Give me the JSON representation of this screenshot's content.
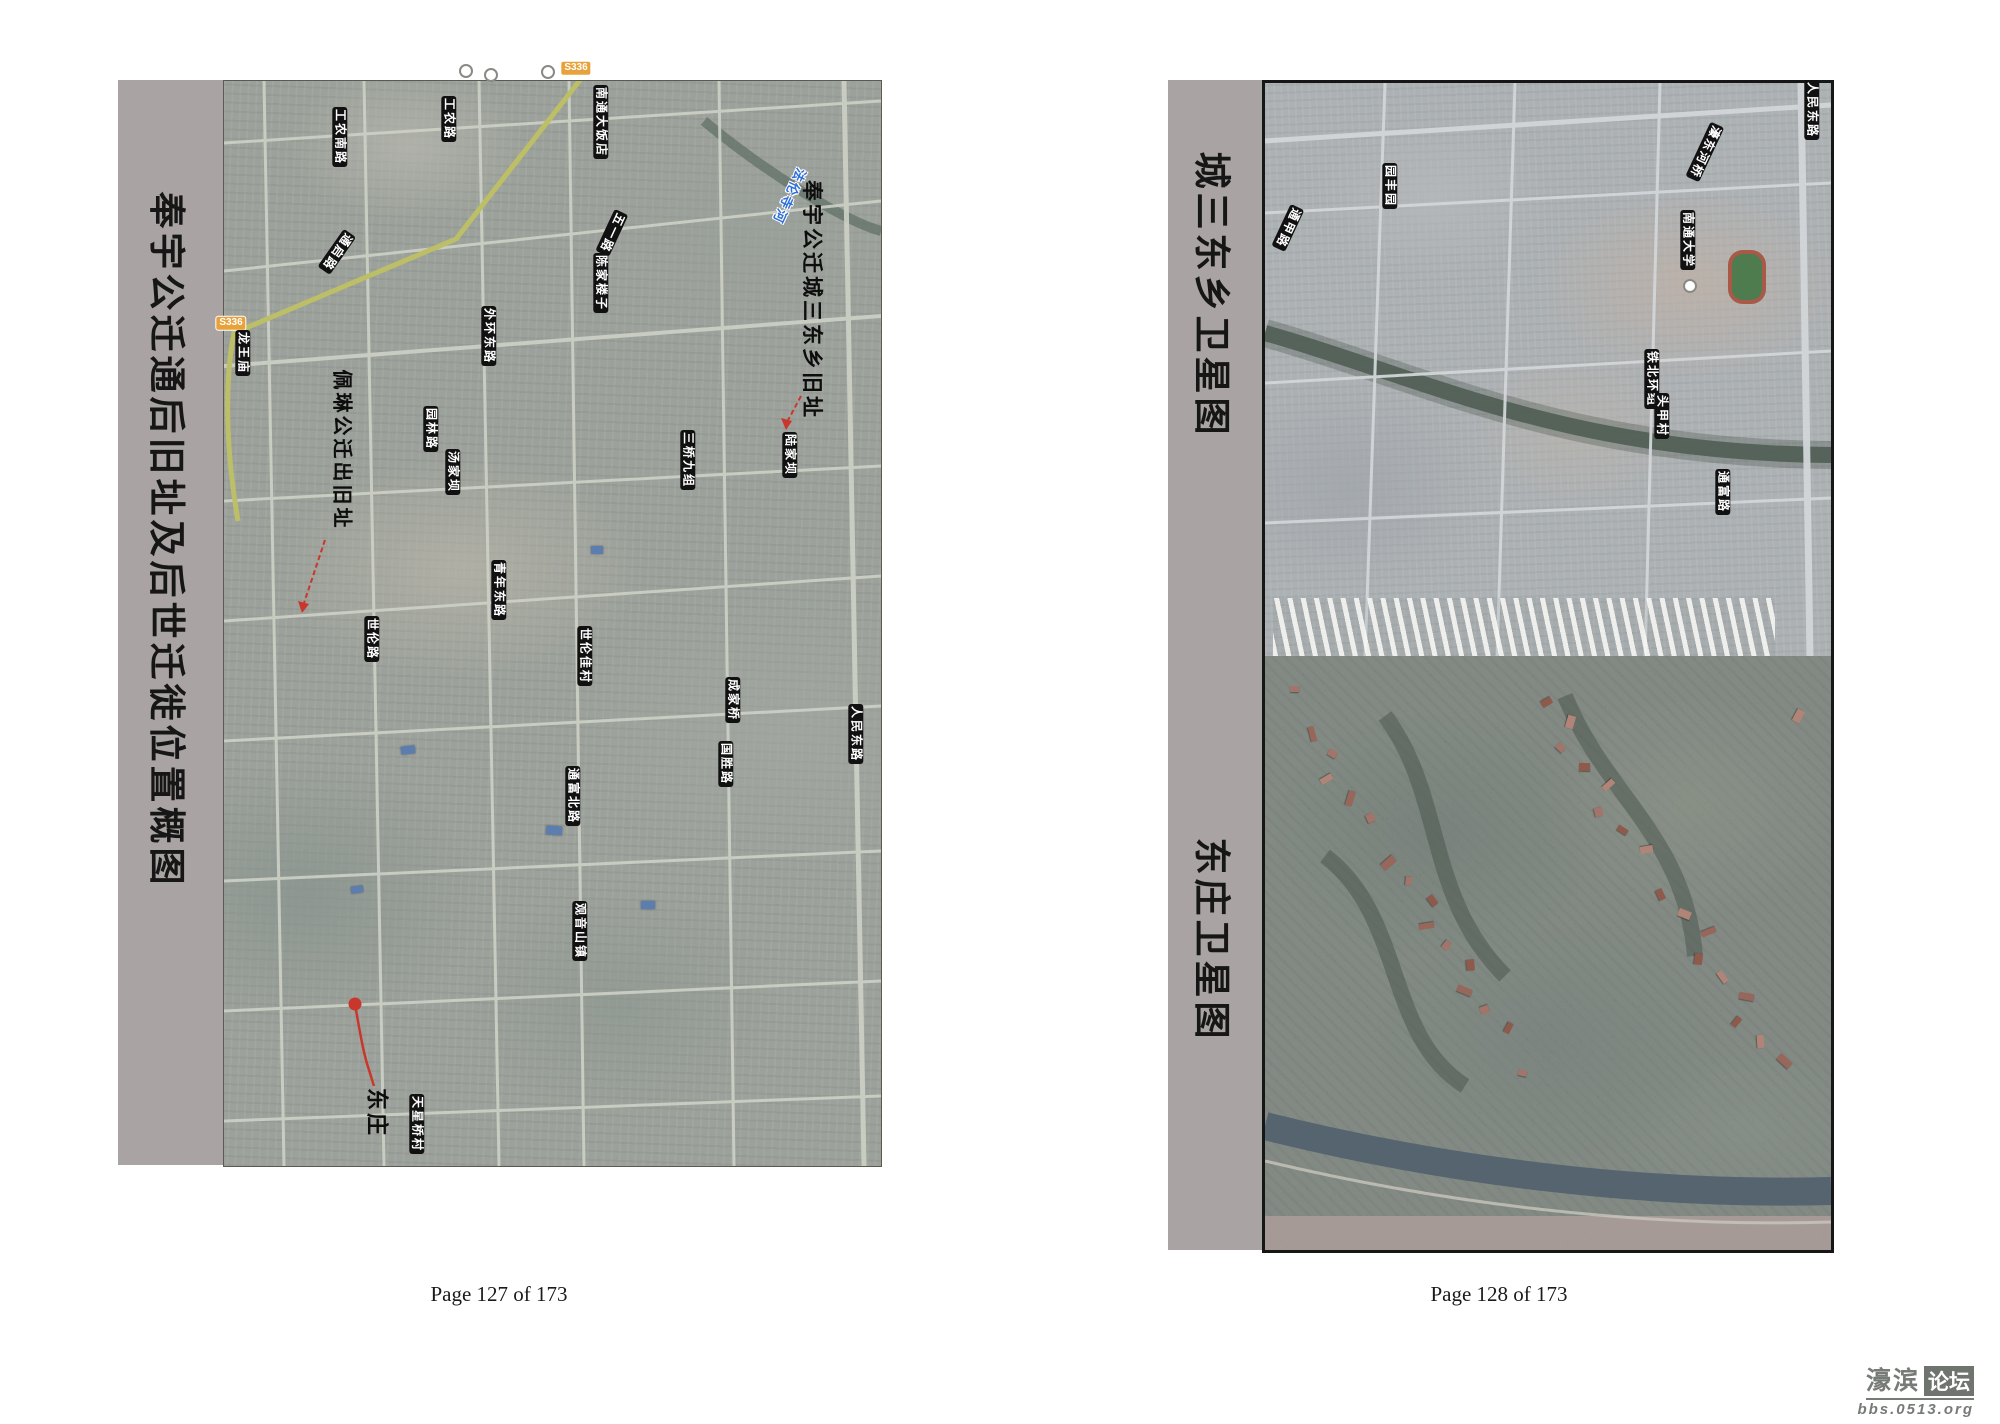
{
  "left_page": {
    "title": "奉宇公迁通后旧址及后世迁徙位置概图",
    "footer": "Page 127 of 173",
    "labels": [
      {
        "t": "工农南路",
        "x": 340,
        "y": 137,
        "r": 90,
        "type": "road"
      },
      {
        "t": "通启路",
        "x": 337,
        "y": 252,
        "r": 125,
        "type": "road"
      },
      {
        "t": "工农路",
        "x": 449,
        "y": 119,
        "r": 90,
        "type": "road"
      },
      {
        "t": "南通大饭店",
        "x": 601,
        "y": 122,
        "r": 90,
        "type": "road"
      },
      {
        "t": "五一路",
        "x": 612,
        "y": 233,
        "r": 115,
        "type": "road"
      },
      {
        "t": "陈家楼子",
        "x": 601,
        "y": 283,
        "r": 90,
        "type": "road"
      },
      {
        "t": "法伦寺河",
        "x": 789,
        "y": 196,
        "r": 115,
        "type": "river"
      },
      {
        "t": "外环东路",
        "x": 489,
        "y": 336,
        "r": 90,
        "type": "road"
      },
      {
        "t": "S336",
        "x": 231,
        "y": 323,
        "r": 0,
        "type": "shield"
      },
      {
        "t": "S336",
        "x": 576,
        "y": 68,
        "r": 0,
        "type": "shield"
      },
      {
        "t": "龙王庙",
        "x": 243,
        "y": 353,
        "r": 90,
        "type": "road"
      },
      {
        "t": "园林路",
        "x": 431,
        "y": 429,
        "r": 90,
        "type": "road"
      },
      {
        "t": "汤家坝",
        "x": 453,
        "y": 472,
        "r": 90,
        "type": "road"
      },
      {
        "t": "三桥九组",
        "x": 688,
        "y": 460,
        "r": 90,
        "type": "road"
      },
      {
        "t": "陆家坝",
        "x": 790,
        "y": 455,
        "r": 90,
        "type": "road"
      },
      {
        "t": "青年东路",
        "x": 499,
        "y": 590,
        "r": 90,
        "type": "road"
      },
      {
        "t": "世伦路",
        "x": 372,
        "y": 639,
        "r": 90,
        "type": "road"
      },
      {
        "t": "世伦佳村",
        "x": 585,
        "y": 656,
        "r": 90,
        "type": "road"
      },
      {
        "t": "成家桥",
        "x": 733,
        "y": 700,
        "r": 90,
        "type": "road"
      },
      {
        "t": "国胜路",
        "x": 726,
        "y": 764,
        "r": 90,
        "type": "road"
      },
      {
        "t": "人民东路",
        "x": 856,
        "y": 734,
        "r": 90,
        "type": "road"
      },
      {
        "t": "通富北路",
        "x": 573,
        "y": 796,
        "r": 90,
        "type": "road"
      },
      {
        "t": "观音山镇",
        "x": 580,
        "y": 931,
        "r": 90,
        "type": "road"
      },
      {
        "t": "天星桥村",
        "x": 417,
        "y": 1124,
        "r": 90,
        "type": "road"
      },
      {
        "t": "",
        "x": 466,
        "y": 71,
        "r": 0,
        "type": "poi"
      },
      {
        "t": "",
        "x": 491,
        "y": 75,
        "r": 0,
        "type": "poi"
      },
      {
        "t": "",
        "x": 548,
        "y": 72,
        "r": 0,
        "type": "poi"
      },
      {
        "t": "",
        "x": 355,
        "y": 1004,
        "r": 0,
        "type": "dot"
      },
      {
        "t": "奉宇公迁城三东乡旧址",
        "x": 811,
        "y": 300,
        "r": 90,
        "type": "anno",
        "size": 21
      },
      {
        "t": "佩琳公迁出旧址",
        "x": 341,
        "y": 450,
        "r": 90,
        "type": "anno",
        "size": 20
      },
      {
        "t": "东庄",
        "x": 377,
        "y": 1113,
        "r": 90,
        "type": "anno",
        "size": 22
      }
    ]
  },
  "right_page": {
    "top_title": "城三东乡卫星图",
    "bottom_title": "东庄卫星图",
    "footer": "Page 128 of 173",
    "labels": [
      {
        "t": "人民东路",
        "x": 1812,
        "y": 110,
        "r": 90,
        "type": "road"
      },
      {
        "t": "濠东河桥",
        "x": 1705,
        "y": 152,
        "r": 115,
        "type": "road"
      },
      {
        "t": "南通大学",
        "x": 1688,
        "y": 240,
        "r": 90,
        "type": "road"
      },
      {
        "t": "",
        "x": 1690,
        "y": 286,
        "r": 0,
        "type": "poi"
      },
      {
        "t": "通甲路",
        "x": 1288,
        "y": 228,
        "r": 115,
        "type": "road"
      },
      {
        "t": "园丰园",
        "x": 1390,
        "y": 186,
        "r": 90,
        "type": "road"
      },
      {
        "t": "铁北环组",
        "x": 1652,
        "y": 379,
        "r": 90,
        "type": "road"
      },
      {
        "t": "头甲村",
        "x": 1662,
        "y": 416,
        "r": 90,
        "type": "road"
      },
      {
        "t": "通富路",
        "x": 1723,
        "y": 492,
        "r": 90,
        "type": "road"
      }
    ]
  },
  "watermark": {
    "name": "濠滨",
    "badge": "论坛",
    "url": "bbs.0513.org"
  },
  "colors": {
    "page_bar": "#a9a3a3",
    "label_bg": "#111111",
    "annotation_red": "#c9372c",
    "route_shield": "#e8a23c",
    "river_label": "#2f6fd8"
  }
}
